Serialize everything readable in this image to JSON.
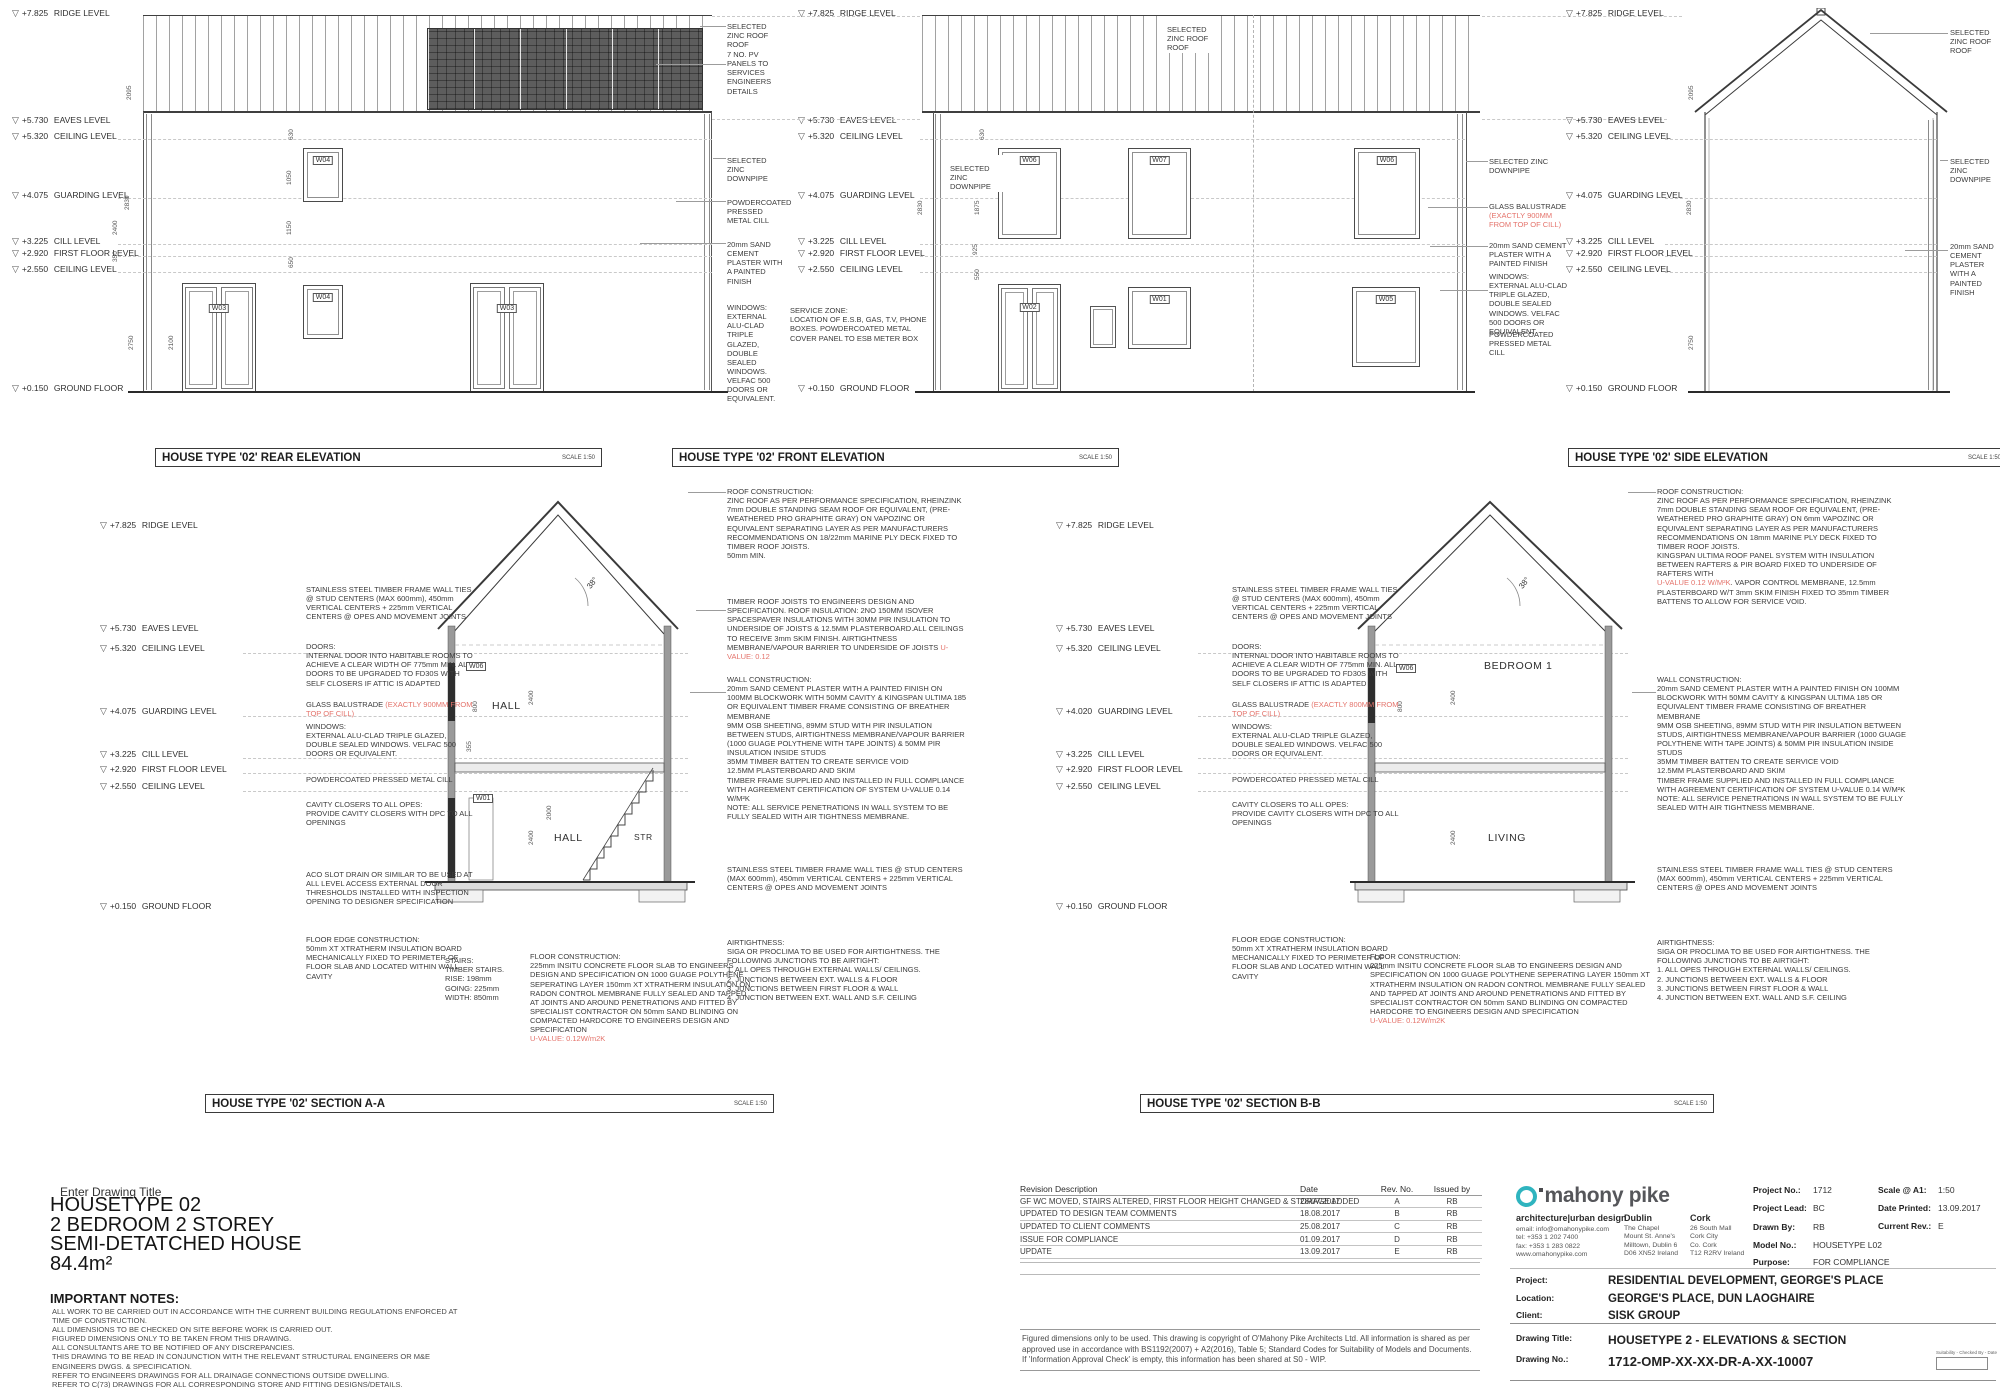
{
  "titles": {
    "rear": {
      "title": "HOUSE TYPE '02' REAR ELEVATION",
      "scale": "SCALE 1:50"
    },
    "front": {
      "title": "HOUSE TYPE '02' FRONT ELEVATION",
      "scale": "SCALE 1:50"
    },
    "side": {
      "title": "HOUSE TYPE '02' SIDE ELEVATION",
      "scale": "SCALE 1:50"
    },
    "section_a": {
      "title": "HOUSE TYPE '02' SECTION A-A",
      "scale": "SCALE 1:50"
    },
    "section_b": {
      "title": "HOUSE TYPE '02' SECTION B-B",
      "scale": "SCALE 1:50"
    }
  },
  "levels": [
    {
      "value": "+7.825",
      "label": "RIDGE LEVEL"
    },
    {
      "value": "+5.730",
      "label": "EAVES LEVEL"
    },
    {
      "value": "+5.320",
      "label": "CEILING LEVEL"
    },
    {
      "value": "+4.075",
      "label": "GUARDING LEVEL"
    },
    {
      "value": "+3.225",
      "label": "CILL LEVEL"
    },
    {
      "value": "+2.920",
      "label": "FIRST FLOOR LEVEL"
    },
    {
      "value": "+2.550",
      "label": "CEILING LEVEL"
    },
    {
      "value": "+0.150",
      "label": "GROUND FLOOR"
    }
  ],
  "levels_b": [
    {
      "value": "+7.825",
      "label": "RIDGE LEVEL"
    },
    {
      "value": "+5.730",
      "label": "EAVES LEVEL"
    },
    {
      "value": "+5.320",
      "label": "CEILING LEVEL"
    },
    {
      "value": "+4.020",
      "label": "GUARDING LEVEL"
    },
    {
      "value": "+3.225",
      "label": "CILL LEVEL"
    },
    {
      "value": "+2.920",
      "label": "FIRST FLOOR LEVEL"
    },
    {
      "value": "+2.550",
      "label": "CEILING LEVEL"
    },
    {
      "value": "+0.150",
      "label": "GROUND FLOOR"
    }
  ],
  "windows": {
    "rear": [
      "W04",
      "W03",
      "W04",
      "W03"
    ],
    "front_upper": [
      "W06",
      "W07",
      "W06"
    ],
    "front_lower": [
      "W02",
      "W01",
      "W05"
    ],
    "section_a": [
      "W06",
      "W01"
    ],
    "section_b": [
      "W06"
    ]
  },
  "rooms": {
    "section_a": [
      "HALL",
      "HALL",
      "STR"
    ],
    "section_b": [
      "BEDROOM 1",
      "LIVING"
    ]
  },
  "dims": {
    "rear": [
      "2095",
      "2830",
      "2400",
      "350",
      "2750",
      "2100",
      "630",
      "1050",
      "1150",
      "650"
    ],
    "front": [
      "2830",
      "630",
      "1875",
      "925",
      "550"
    ],
    "side": [
      "2095",
      "2830",
      "2750"
    ],
    "section_a": [
      "38°",
      "2400",
      "800",
      "355",
      "2400",
      "2000"
    ],
    "section_b": [
      "38°",
      "800",
      "2400",
      "2400"
    ]
  },
  "notes": {
    "rear_col": [
      {
        "text": "SELECTED ZINC ROOF ROOF"
      },
      {
        "text": "7 NO. PV PANELS TO SERVICES ENGINEERS DETAILS"
      },
      {
        "text": "SELECTED ZINC DOWNPIPE"
      },
      {
        "text": "POWDERCOATED PRESSED METAL CILL"
      },
      {
        "text": "20mm SAND CEMENT PLASTER WITH A PAINTED FINISH"
      },
      {
        "text": "WINDOWS: EXTERNAL ALU-CLAD TRIPLE GLAZED, DOUBLE SEALED WINDOWS. VELFAC 500 DOORS OR EQUIVALENT."
      }
    ],
    "service_zone": {
      "text": "SERVICE ZONE:\nLOCATION OF E.S.B, GAS, T.V, PHONE BOXES. POWDERCOATED METAL COVER PANEL TO ESB METER BOX"
    },
    "front_left_downpipe": {
      "text": "SELECTED ZINC DOWNPIPE"
    },
    "front_roof": {
      "text": "SELECTED ZINC ROOF ROOF"
    },
    "front_right": [
      {
        "text": "SELECTED ZINC DOWNPIPE"
      },
      {
        "text": "GLASS BALUSTRADE ",
        "red": "(EXACTLY 900MM FROM TOP OF CILL)"
      },
      {
        "text": "20mm SAND CEMENT PLASTER WITH A PAINTED FINISH"
      },
      {
        "text": "WINDOWS:\nEXTERNAL ALU-CLAD TRIPLE GLAZED, DOUBLE SEALED WINDOWS. VELFAC 500 DOORS OR EQUIVALENT"
      },
      {
        "text": "POWDERCOATED PRESSED METAL CILL"
      }
    ],
    "side_col": [
      {
        "text": "SELECTED ZINC ROOF ROOF"
      },
      {
        "text": "SELECTED ZINC DOWNPIPE"
      },
      {
        "text": "20mm SAND CEMENT PLASTER WITH A PAINTED FINISH"
      }
    ],
    "seca_left": [
      {
        "text": "STAINLESS STEEL TIMBER FRAME WALL TIES @ STUD CENTERS (MAX 600mm), 450mm VERTICAL CENTERS + 225mm VERTICAL CENTERS @ OPES AND MOVEMENT JOINTS"
      },
      {
        "text": "DOORS:\nINTERNAL DOOR INTO HABITABLE ROOMS TO ACHIEVE A CLEAR WIDTH OF 775mm MIN. ALL DOORS T0 BE UPGRADED TO FD30S WITH SELF CLOSERS IF ATTIC IS ADAPTED"
      },
      {
        "text": "GLASS BALUSTRADE ",
        "red": "(EXACTLY 900MM FROM TOP OF CILL)"
      },
      {
        "text": "WINDOWS:\nEXTERNAL ALU-CLAD TRIPLE GLAZED, DOUBLE SEALED WINDOWS. VELFAC 500 DOORS OR EQUIVALENT."
      },
      {
        "text": "POWDERCOATED PRESSED METAL CILL"
      },
      {
        "text": "CAVITY CLOSERS TO ALL OPES:\nPROVIDE CAVITY CLOSERS WITH DPC TO ALL OPENINGS"
      },
      {
        "text": "ACO SLOT DRAIN OR SIMILAR TO BE USED AT ALL LEVEL ACCESS EXTERNAL DOOR THRESHOLDS INSTALLED WITH INSPECTION OPENING TO DESIGNER SPECIFICATION"
      },
      {
        "text": "FLOOR EDGE CONSTRUCTION:\n50mm XT XTRATHERM INSULATION BOARD MECHANICALLY FIXED TO PERIMETER OF FLOOR SLAB AND LOCATED WITHIN WALL CAVITY"
      }
    ],
    "seca_right": [
      {
        "text": "ROOF CONSTRUCTION:\nZINC ROOF AS PER PERFORMANCE SPECIFICATION, RHEINZINK 7mm DOUBLE STANDING SEAM ROOF OR EQUIVALENT, (PRE-WEATHERED PRO GRAPHITE GRAY) ON VAPOZINC OR EQUIVALENT SEPARATING LAYER AS PER MANUFACTURERS RECOMMENDATIONS ON 18/22mm MARINE PLY DECK FIXED TO TIMBER ROOF JOISTS.\n50mm MIN."
      },
      {
        "text": "TIMBER ROOF JOISTS TO ENGINEERS DESIGN AND SPECIFICATION. ROOF INSULATION: 2NO 150MM ISOVER SPACESPAVER INSULATIONS WITH 30MM PIR INSULATION TO UNDERSIDE OF JOISTS & 12.5MM PLASTERBOARD.ALL CEILINGS TO RECEIVE 3mm SKIM FINISH. AIRTIGHTNESS MEMBRANE/VAPOUR BARRIER TO UNDERSIDE OF JOISTS ",
        "red": "U-VALUE: 0.12"
      },
      {
        "text": "WALL CONSTRUCTION:\n20mm SAND CEMENT PLASTER WITH A PAINTED FINISH ON 100MM BLOCKWORK WITH 50MM CAVITY & KINGSPAN ULTIMA 185 OR EQUIVALENT TIMBER FRAME CONSISTING OF BREATHER MEMBRANE\n9MM OSB SHEETING, 89MM STUD WITH PIR INSULATION BETWEEN STUDS, AIRTIGHTNESS MEMBRANE/VAPOUR BARRIER (1000 GUAGE POLYTHENE WITH TAPE JOINTS) & 50MM PIR INSULATION INSIDE STUDS\n35MM TIMBER BATTEN TO CREATE SERVICE VOID\n12.5MM PLASTERBOARD AND SKIM\nTIMBER FRAME SUPPLIED AND INSTALLED IN FULL COMPLIANCE WITH AGREEMENT CERTIFICATION OF SYSTEM U-VALUE 0.14 W/M²K\nNOTE: ALL SERVICE PENETRATIONS IN WALL SYSTEM TO BE FULLY SEALED WITH AIR TIGHTNESS MEMBRANE."
      },
      {
        "text": "STAINLESS STEEL TIMBER FRAME WALL TIES @ STUD CENTERS (MAX 600mm), 450mm VERTICAL CENTERS + 225mm VERTICAL CENTERS @ OPES AND MOVEMENT JOINTS"
      },
      {
        "text": "AIRTIGHTNESS:\nSIGA OR PROCLIMA TO BE USED FOR AIRTIGHTNESS. THE FOLLOWING JUNCTIONS TO BE AIRTIGHT:\n1. ALL OPES THROUGH EXTERNAL WALLS/ CEILINGS.\n2. JUNCTIONS BETWEEN EXT. WALLS & FLOOR\n3. JUNCTIONS BETWEEN FIRST FLOOR & WALL\n4. JUNCTION BETWEEN EXT. WALL AND S.F. CEILING"
      }
    ],
    "secb_left": [
      {
        "text": "STAINLESS STEEL TIMBER FRAME WALL TIES @ STUD CENTERS (MAX 600mm), 450mm VERTICAL CENTERS + 225mm VERTICAL CENTERS @ OPES AND MOVEMENT JOINTS"
      },
      {
        "text": "DOORS:\nINTERNAL DOOR INTO HABITABLE ROOMS TO ACHIEVE A CLEAR WIDTH OF 775mm MIN. ALL DOORS TO BE UPGRADED TO FD30S WITH SELF CLOSERS IF ATTIC IS ADAPTED"
      },
      {
        "text": "GLASS BALUSTRADE ",
        "red": "(EXACTLY 800MM FROM TOP OF CILL)"
      },
      {
        "text": "WINDOWS:\nEXTERNAL ALU-CLAD TRIPLE GLAZED, DOUBLE SEALED WINDOWS. VELFAC 500 DOORS OR EQUIVALENT."
      },
      {
        "text": "POWDERCOATED PRESSED METAL CILL"
      },
      {
        "text": "CAVITY CLOSERS TO ALL OPES:\nPROVIDE CAVITY CLOSERS WITH DPC TO ALL OPENINGS"
      },
      {
        "text": "FLOOR EDGE CONSTRUCTION:\n50mm XT XTRATHERM INSULATION BOARD MECHANICALLY FIXED TO PERIMETER OF FLOOR SLAB AND LOCATED WITHIN WALL CAVITY"
      }
    ],
    "secb_right": [
      {
        "text": "ROOF CONSTRUCTION:\nZINC ROOF AS PER PERFORMANCE SPECIFICATION, RHEINZINK 7mm DOUBLE STANDING SEAM ROOF OR EQUIVALENT, (PRE-WEATHERED PRO GRAPHITE GRAY) ON 6mm VAPOZINC OR EQUIVALENT SEPARATING LAYER AS PER MANUFACTURERS RECOMMENDATIONS ON 18mm MARINE PLY DECK FIXED TO TIMBER ROOF JOISTS.\nKINGSPAN ULTIMA ROOF PANEL SYSTEM WITH INSULATION BETWEEN RAFTERS & PIR BOARD FIXED TO UNDERSIDE OF RAFTERS WITH\n",
        "red": "U-VALUE 0.12 W/M²K",
        "text2": ". VAPOR CONTROL MEMBRANE, 12.5mm PLASTERBOARD W/T 3mm SKIM FINISH FIXED TO 35mm TIMBER BATTENS TO ALLOW FOR SERVICE VOID."
      },
      {
        "text": "WALL CONSTRUCTION:\n20mm SAND CEMENT PLASTER WITH A PAINTED FINISH ON 100MM BLOCKWORK WITH 50MM CAVITY & KINGSPAN ULTIMA 185 OR EQUIVALENT TIMBER FRAME CONSISTING OF BREATHER MEMBRANE\n9MM OSB SHEETING, 89MM STUD WITH PIR INSULATION BETWEEN STUDS, AIRTIGHTNESS MEMBRANE/VAPOUR BARRIER (1000 GUAGE POLYTHENE WITH TAPE JOINTS) & 50MM PIR INSULATION INSIDE STUDS\n35MM TIMBER BATTEN TO CREATE SERVICE VOID\n12.5MM PLASTERBOARD AND SKIM\nTIMBER FRAME SUPPLIED AND INSTALLED IN FULL COMPLIANCE WITH AGREEMENT CERTIFICATION OF SYSTEM U-VALUE 0.14 W/M²K\nNOTE: ALL SERVICE PENETRATIONS IN WALL SYSTEM TO BE FULLY SEALED WITH AIR TIGHTNESS MEMBRANE."
      },
      {
        "text": "STAINLESS STEEL TIMBER FRAME WALL TIES @ STUD CENTERS (MAX 600mm), 450mm VERTICAL CENTERS + 225mm VERTICAL CENTERS @ OPES AND MOVEMENT JOINTS"
      },
      {
        "text": "AIRTIGHTNESS:\nSIGA OR PROCLIMA TO BE USED FOR AIRTIGHTNESS. THE FOLLOWING JUNCTIONS TO BE AIRTIGHT:\n1. ALL OPES THROUGH EXTERNAL WALLS/ CEILINGS.\n2. JUNCTIONS BETWEEN EXT. WALLS & FLOOR\n3. JUNCTIONS BETWEEN FIRST FLOOR & WALL\n4. JUNCTION BETWEEN EXT. WALL AND S.F. CEILING"
      }
    ],
    "stairs": {
      "text": "STAIRS:\nTIMBER STAIRS.\nRISE: 198mm\nGOING: 225mm\nWIDTH: 850mm"
    },
    "floor_a": {
      "text": "FLOOR CONSTRUCTION:\n225mm INSITU CONCRETE FLOOR SLAB TO ENGINEERS DESIGN AND SPECIFICATION ON 1000 GUAGE POLYTHENE SEPERATING LAYER 150mm XT XTRATHERM INSULATION ON RADON CONTROL MEMBRANE FULLY SEALED AND TAPPED AT JOINTS AND AROUND PENETRATIONS AND FITTED BY SPECIALIST CONTRACTOR ON 50mm SAND BLINDING ON COMPACTED HARDCORE TO ENGINEERS DESIGN AND SPECIFICATION\n",
      "red": "U-VALUE: 0.12W/m2K"
    },
    "floor_b": {
      "text": "FLOOR CONSTRUCTION:\n225mm INSITU CONCRETE FLOOR SLAB TO ENGINEERS DESIGN AND SPECIFICATION ON 1000 GUAGE POLYTHENE SEPERATING LAYER 150mm XT XTRATHERM INSULATION ON RADON CONTROL MEMBRANE FULLY SEALED AND TAPPED AT JOINTS AND AROUND PENETRATIONS AND FITTED BY SPECIALIST CONTRACTOR ON 50mm SAND BLINDING ON COMPACTED HARDCORE TO ENGINEERS DESIGN AND SPECIFICATION\n",
      "red": "U-VALUE: 0.12W/m2K"
    }
  },
  "title_block": {
    "drawing_title_label": "Enter Drawing Title",
    "title_lines": [
      "HOUSETYPE 02",
      "2 BEDROOM 2 STOREY",
      "SEMI-DETATCHED HOUSE",
      "84.4m²"
    ],
    "important_notes_title": "IMPORTANT NOTES:",
    "important_notes": [
      "ALL WORK TO BE CARRIED OUT IN ACCORDANCE WITH THE CURRENT BUILDING REGULATIONS ENFORCED AT",
      "TIME OF CONSTRUCTION.",
      "ALL DIMENSIONS TO BE CHECKED ON SITE BEFORE WORK IS CARRIED OUT.",
      "FIGURED DIMENSIONS ONLY TO BE TAKEN FROM THIS DRAWING.",
      "ALL CONSULTANTS ARE TO BE NOTIFIED OF ANY DISCREPANCIES.",
      "THIS DRAWING TO BE READ IN CONJUNCTION WITH THE RELEVANT STRUCTURAL ENGINEERS OR M&E",
      "ENGINEERS DWGS. & SPECIFICATION.",
      "REFER TO ENGINEERS DRAWINGS FOR ALL DRAINAGE CONNECTIONS OUTSIDE DWELLING.",
      "REFER TO C(73) DRAWINGS FOR ALL CORRESPONDING STORE AND FITTING DESIGNS/DETAILS."
    ],
    "revisions": {
      "headers": [
        "Revision Description",
        "Date",
        "Rev. No.",
        "Issued by"
      ],
      "rows": [
        {
          "description": "GF WC MOVED, STAIRS ALTERED, FIRST FLOOR HEIGHT CHANGED & STORAGE ADDED",
          "date": "28/07/2017",
          "rev": "A",
          "issued": "RB"
        },
        {
          "description": "UPDATED TO DESIGN TEAM COMMENTS",
          "date": "18.08.2017",
          "rev": "B",
          "issued": "RB"
        },
        {
          "description": "UPDATED TO CLIENT COMMENTS",
          "date": "25.08.2017",
          "rev": "C",
          "issued": "RB"
        },
        {
          "description": "ISSUE FOR COMPLIANCE",
          "date": "01.09.2017",
          "rev": "D",
          "issued": "RB"
        },
        {
          "description": "UPDATE",
          "date": "13.09.2017",
          "rev": "E",
          "issued": "RB"
        }
      ]
    },
    "disclaimer": "Figured dimensions only to be used. This drawing is copyright of O'Mahony Pike Architects Ltd. All information is shared as per approved use in accordance with BS1192(2007) + A2(2016), Table 5; Standard Codes for Suitability of Models and Documents. If 'Information Approval Check' is empty, this information has been shared at S0 - WIP.",
    "company": {
      "logo_o": "o",
      "logo": "mahony pike",
      "tagline": "architecture|urban design",
      "contact": [
        "email: info@omahonypike.com",
        "tel: +353 1 202 7400",
        "fax: +353 1 283 0822",
        "www.omahonypike.com"
      ],
      "dublin_title": "Dublin",
      "dublin": [
        "The Chapel",
        "Mount St. Anne's",
        "Milltown, Dublin 6",
        "D06 XN52 Ireland"
      ],
      "cork_title": "Cork",
      "cork": [
        "26 South Mall",
        "Cork City",
        "Co. Cork",
        "T12 R2RV Ireland"
      ]
    },
    "fields": [
      {
        "label": "Project No.:",
        "value": "1712"
      },
      {
        "label": "Project Lead:",
        "value": "BC"
      },
      {
        "label": "Drawn By:",
        "value": "RB"
      },
      {
        "label": "Model No.:",
        "value": "HOUSETYPE L02"
      },
      {
        "label": "Purpose:",
        "value": "FOR COMPLIANCE"
      }
    ],
    "fields2": [
      {
        "label": "Scale @ A1:",
        "value": "1:50"
      },
      {
        "label": "Date Printed:",
        "value": "13.09.2017"
      },
      {
        "label": "Current Rev.:",
        "value": "E"
      }
    ],
    "project_rows": [
      {
        "label": "Project:",
        "value": "RESIDENTIAL DEVELOPMENT, GEORGE'S PLACE"
      },
      {
        "label": "Location:",
        "value": "GEORGE'S PLACE, DUN LAOGHAIRE"
      },
      {
        "label": "Client:",
        "value": "SISK GROUP"
      }
    ],
    "drawing_rows": [
      {
        "label": "Drawing Title:",
        "value": "HOUSETYPE 2 - ELEVATIONS & SECTION"
      },
      {
        "label": "Drawing No.:",
        "value": "1712-OMP-XX-XX-DR-A-XX-10007"
      }
    ],
    "suitability_label": "Suitability - Checked By - Date"
  },
  "colors": {
    "accent_red": "#e4736b",
    "logo_teal": "#2fb4bf",
    "line_dark": "#3a3a3a"
  }
}
